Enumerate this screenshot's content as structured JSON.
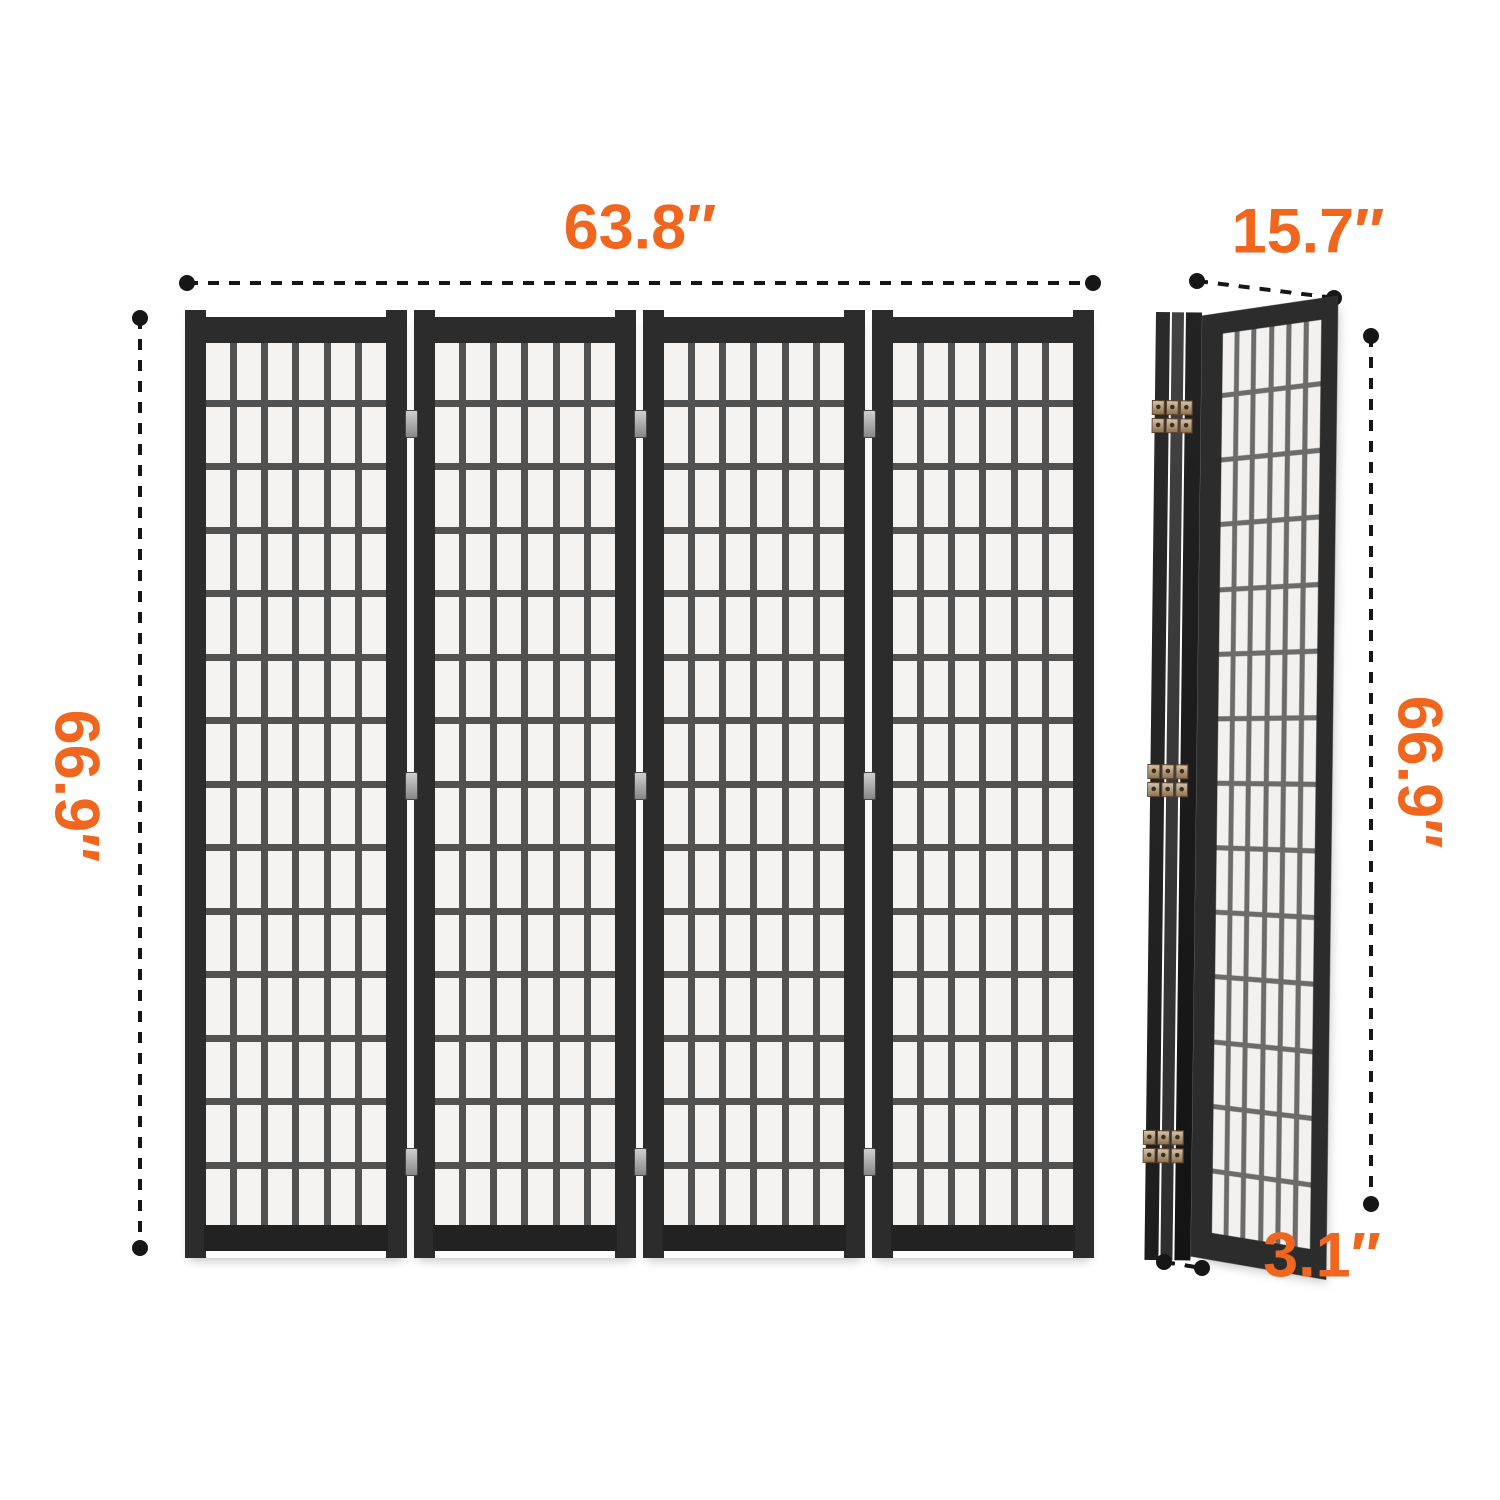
{
  "diagram": {
    "type": "product-dimension-diagram",
    "subject": "4-panel folding shoji room divider screen",
    "views": {
      "front": {
        "name": "front view (unfolded 4-panel screen)",
        "width_label": "63.8″",
        "height_label": "66.9″",
        "panels": 4,
        "grid_cols": 6,
        "grid_rows": 14,
        "hinge_offsets": [
          100,
          462,
          838
        ]
      },
      "folded": {
        "name": "side view (folded screen)",
        "depth_label": "15.7″",
        "height_label": "66.9″",
        "thickness_label": "3.1″",
        "stacked_edges": 3,
        "grid_cols": 6,
        "grid_rows": 14,
        "hinge_offsets": [
          88,
          452,
          818
        ]
      }
    },
    "colors": {
      "accent": "#f0661f",
      "frame": "#2c2c2c",
      "frame_dark": "#222222",
      "muntin": "#515151",
      "muntin_light": "#6b6b6b",
      "cell": "#f4f3f1",
      "line": "#161616",
      "hinge": "#8f7351"
    }
  }
}
